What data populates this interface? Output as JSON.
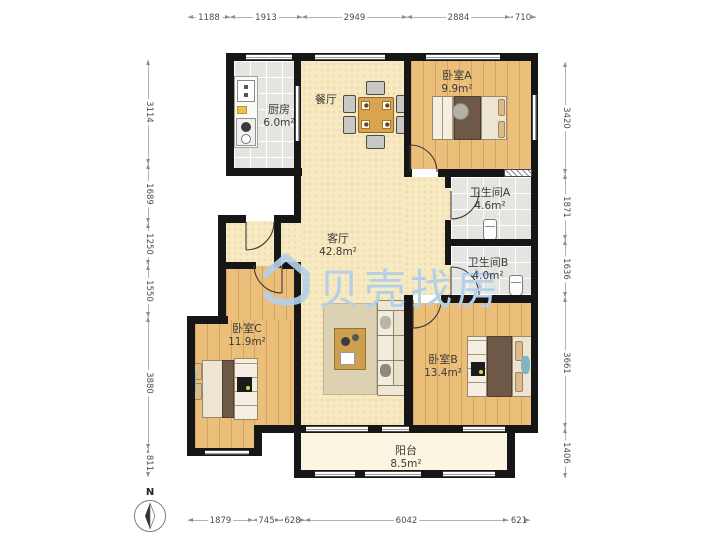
{
  "compass": {
    "north_label": "N"
  },
  "watermark": {
    "text": "贝壳找房"
  },
  "rooms": {
    "kitchen": {
      "name": "厨房",
      "area": "6.0m²"
    },
    "dining": {
      "name": "餐厅"
    },
    "bedroom_a": {
      "name": "卧室A",
      "area": "9.9m²"
    },
    "bath_a": {
      "name": "卫生间A",
      "area": "4.6m²"
    },
    "bath_b": {
      "name": "卫生间B",
      "area": "4.0m²"
    },
    "living": {
      "name": "客厅",
      "area": "42.8m²"
    },
    "bedroom_c": {
      "name": "卧室C",
      "area": "11.9m²"
    },
    "bedroom_b": {
      "name": "卧室B",
      "area": "13.4m²"
    },
    "balcony": {
      "name": "阳台",
      "area": "8.5m²"
    }
  },
  "dimensions": {
    "top": [
      "1188",
      "1913",
      "2949",
      "2884",
      "710"
    ],
    "bottom": [
      "1879",
      "745",
      "628",
      "6042",
      "621"
    ],
    "left": [
      "3114",
      "1689",
      "1250",
      "1550",
      "3880",
      "811"
    ],
    "right": [
      "3420",
      "1871",
      "1636",
      "3661",
      "1406"
    ]
  }
}
